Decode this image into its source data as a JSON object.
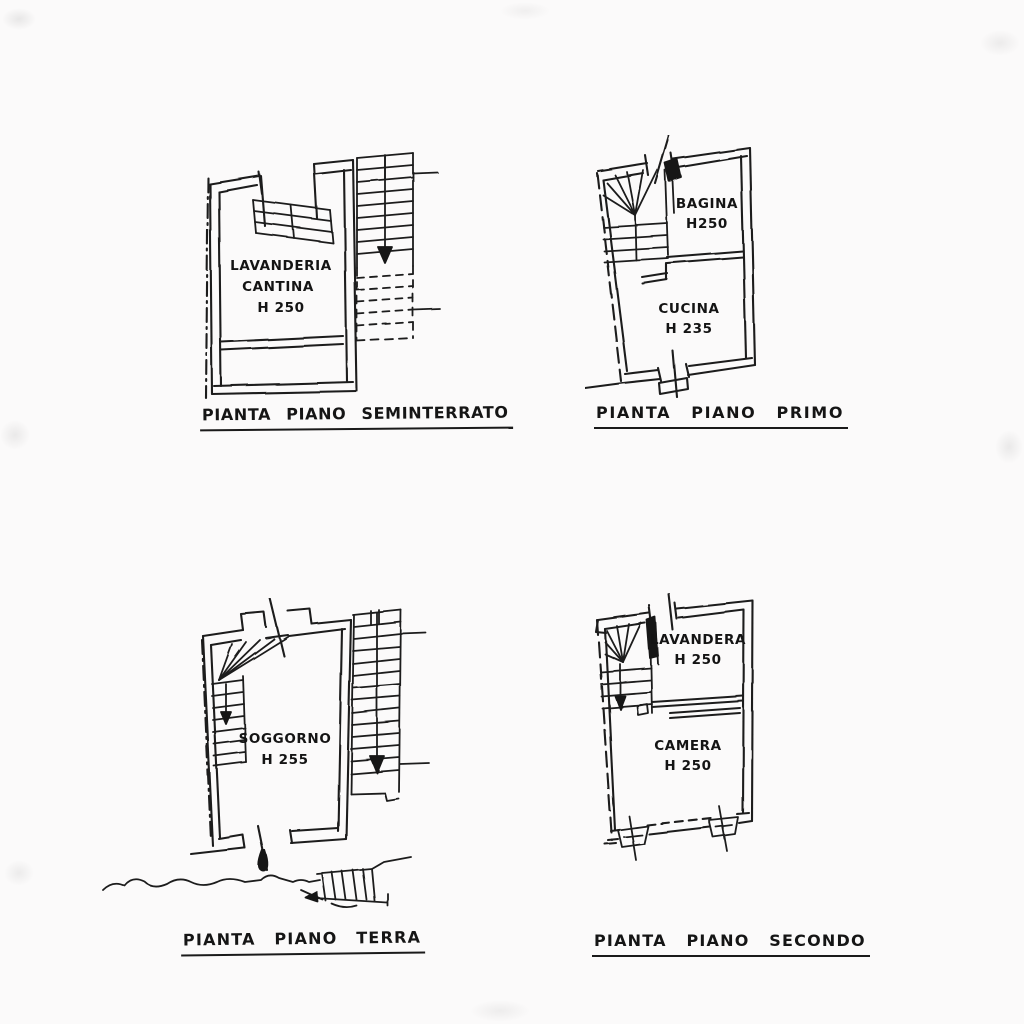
{
  "page": {
    "paper_color": "#fbfafa",
    "ink_color": "#1c1c1c"
  },
  "plans": [
    {
      "id": "seminterrato",
      "caption": "PIANTA PIANO SEMINTERRATO",
      "rooms": [
        {
          "lines": [
            "LAVANDERIA",
            "CANTINA"
          ],
          "height": "H 250"
        }
      ]
    },
    {
      "id": "primo",
      "caption": "PIANTA PIANO PRIMO",
      "rooms": [
        {
          "lines": [
            "BAGINA"
          ],
          "height": "H250"
        },
        {
          "lines": [
            "CUCINA"
          ],
          "height": "H 235"
        }
      ]
    },
    {
      "id": "terra",
      "caption": "PIANTA PIANO TERRA",
      "rooms": [
        {
          "lines": [
            "SOGGORNO"
          ],
          "height": "H 255"
        }
      ]
    },
    {
      "id": "secondo",
      "caption": "PIANTA PIANO SECONDO",
      "rooms": [
        {
          "lines": [
            "LAVANDERA"
          ],
          "height": "H 250"
        },
        {
          "lines": [
            "CAMERA"
          ],
          "height": "H 250"
        }
      ]
    }
  ]
}
